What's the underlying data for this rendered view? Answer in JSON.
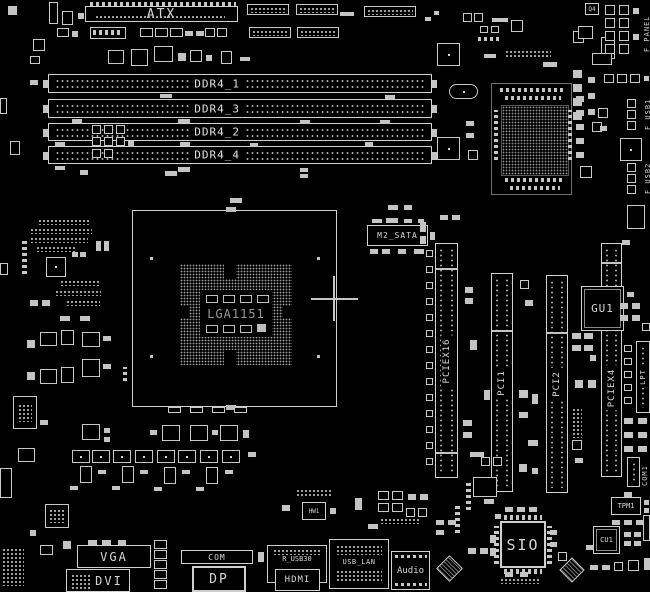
{
  "colors": {
    "background": "#000000",
    "outline": "#d4d4d4",
    "text": "#d2d2d2",
    "dim_text": "#989898"
  },
  "top": {
    "atx": "ATX"
  },
  "memory": {
    "slots": [
      {
        "label": "DDR4_1"
      },
      {
        "label": "DDR4_3"
      },
      {
        "label": "DDR4_2"
      },
      {
        "label": "DDR4_4"
      }
    ]
  },
  "cpu": {
    "socket": "LGA1151"
  },
  "storage": {
    "m2": "M2_SATA"
  },
  "expansion": {
    "slots": [
      {
        "label": "PCIEX16"
      },
      {
        "label": "PCI1"
      },
      {
        "label": "PCI2"
      },
      {
        "label": "PCIEX4"
      }
    ]
  },
  "chips": {
    "gu1": "GU1",
    "q4": "Q4",
    "tpm1": "TPM1",
    "cu1": "CU1",
    "sio": "SIO",
    "audio": "Audio",
    "hw1": "HW1"
  },
  "headers": {
    "f_panel": "F_PANEL",
    "f_usb1": "F_USB1",
    "f_usb2": "F_USB2",
    "lpt": "LPT",
    "com1": "COM1"
  },
  "rear_io": {
    "vga": "VGA",
    "dvi": "DVI",
    "com": "COM",
    "dp": "DP",
    "r_usb30": "R_USB30",
    "hdmi": "HDMI",
    "usb_lan": "USB_LAN"
  }
}
